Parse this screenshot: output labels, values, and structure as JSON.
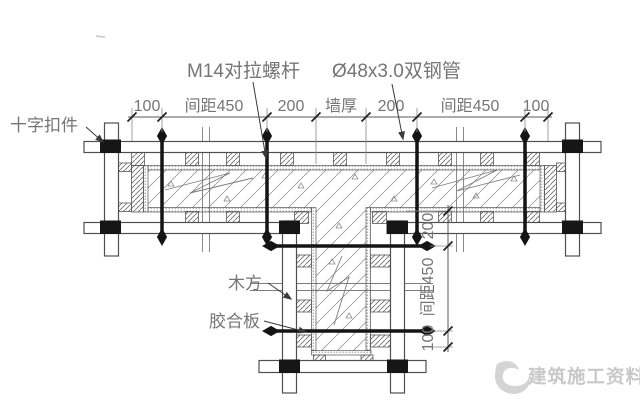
{
  "diagram": {
    "title_labels": {
      "tie_rod": "M14对拉螺杆",
      "steel_pipe": "Ø48x3.0双钢管"
    },
    "component_labels": {
      "cross_coupler": "十字扣件",
      "timber": "木方",
      "plywood": "胶合板"
    },
    "dim_top": [
      "100",
      "间距450",
      "200",
      "墙厚",
      "200",
      "间距450",
      "100"
    ],
    "dim_side": [
      "200",
      "间距450",
      "100"
    ],
    "watermark": "建筑施工资料",
    "colors": {
      "line": "#4f4f4f",
      "text": "#757575",
      "tie_rod": "#141414",
      "coupler": "#161616",
      "watermark": "#c8c8c8",
      "background": "#ffffff"
    }
  }
}
